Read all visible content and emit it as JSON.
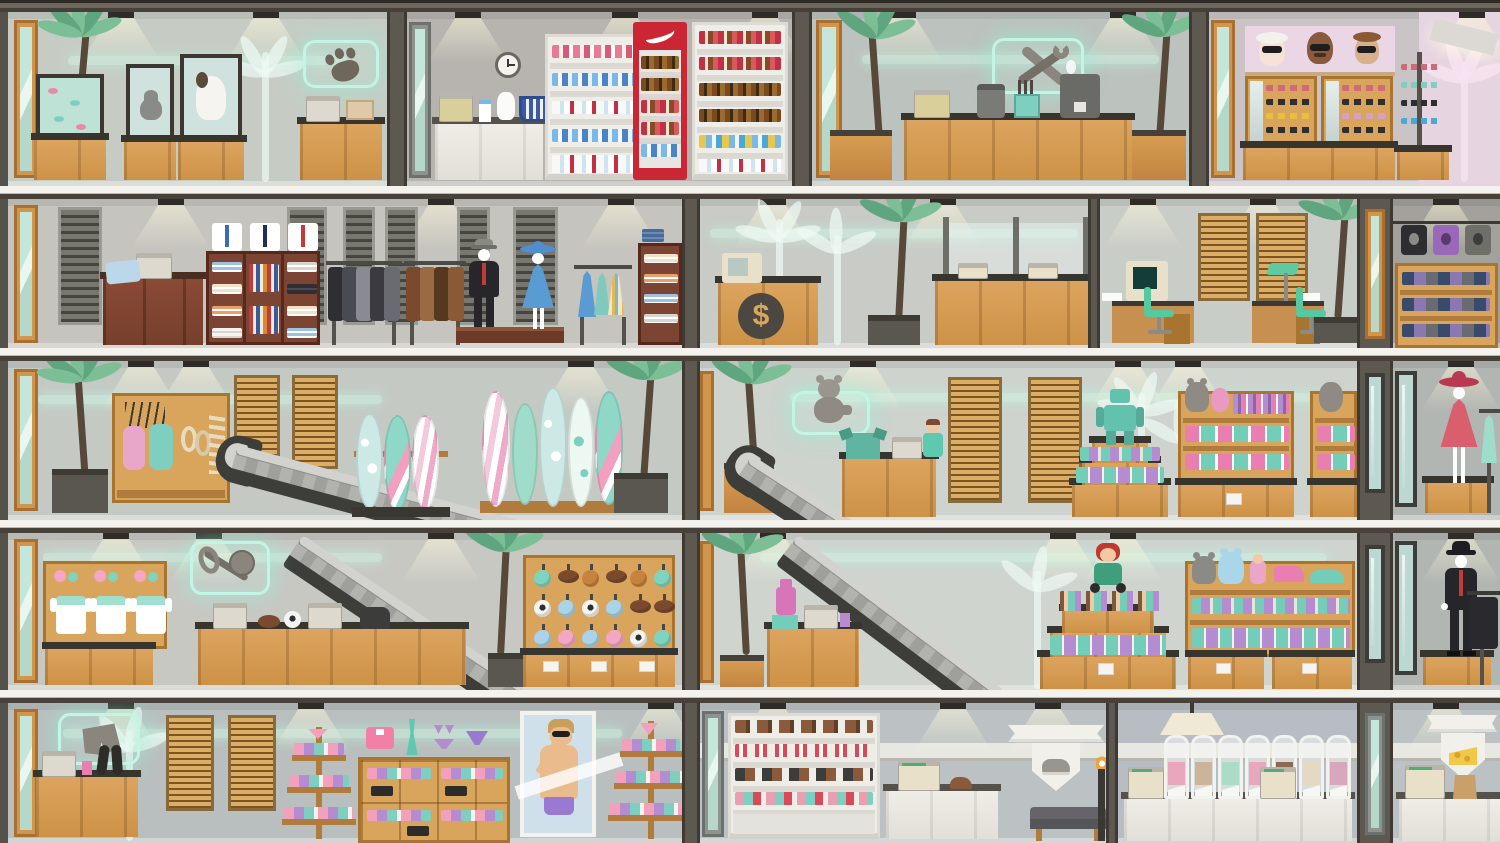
{
  "scene": {
    "type": "shopping-mall-cross-section",
    "floors": [
      {
        "id": "floor-1",
        "shops": [
          {
            "name": "pet-shop",
            "sign_icon": "paw-icon"
          },
          {
            "name": "convenience-store",
            "sign_icon": "none"
          },
          {
            "name": "repair-shop",
            "sign_icon": "wrench-icon"
          },
          {
            "name": "eyewear-shop",
            "sign_icon": "sunglasses-banner"
          }
        ]
      },
      {
        "id": "floor-2",
        "shops": [
          {
            "name": "menswear-store"
          },
          {
            "name": "bank-office",
            "emblem": "$"
          },
          {
            "name": "office"
          },
          {
            "name": "tshirt-shop"
          }
        ]
      },
      {
        "id": "floor-3",
        "shops": [
          {
            "name": "sporting-goods-surf-shop"
          },
          {
            "name": "toy-store",
            "sign_icon": "teddy-bear-icon"
          },
          {
            "name": "womens-boutique"
          }
        ]
      },
      {
        "id": "floor-4",
        "shops": [
          {
            "name": "sporting-goods-store",
            "sign_icon": "sports-gear-icon"
          },
          {
            "name": "toy-store-lower"
          },
          {
            "name": "menswear-boutique"
          }
        ]
      },
      {
        "id": "floor-5",
        "shops": [
          {
            "name": "swimwear-shop",
            "sign_icon": "swim-trunks-icon"
          },
          {
            "name": "shoe-store",
            "sign_icon": "shoe-crest"
          },
          {
            "name": "bulk-candy-store"
          },
          {
            "name": "deli-cheese-shop",
            "sign_icon": "cheese-crest"
          }
        ]
      }
    ]
  },
  "bank": {
    "emblem": "$"
  },
  "palette": {
    "frame_dark": "#47413a",
    "slab_white": "#f4f2ed",
    "wall_gray": "#c5c9c4",
    "wood_tan": "#d49a55",
    "dark_wood": "#7c4433",
    "neon_teal": "#c4f5e4",
    "glow_mint": "#cdf3e2",
    "palm_green": "#7cbf97",
    "escalator_gray": "#b2b2af",
    "cooler_red": "#cb2634",
    "accent_pink": "#f2a7c3",
    "accent_teal": "#74cdb8",
    "accent_purple": "#b48ccf"
  },
  "decor": {
    "ball_map": {
      "t": "#7fd4bf",
      "bb": "#c8823f",
      "bl": "#a9d3e8",
      "pk": "#f2a7c3",
      "fb": "#7b4a2e",
      "sc": "#f4f4f2"
    },
    "ball_names": {
      "t": "teal-ball",
      "bb": "basketball",
      "bl": "blue-ball",
      "pk": "pink-ball",
      "fb": "football",
      "sc": "soccer-ball"
    },
    "ball_rows": [
      [
        "t",
        "fb",
        "bb",
        "fb",
        "bb",
        "t"
      ],
      [
        "sc",
        "bl",
        "sc",
        "bl",
        "fb",
        "fb"
      ],
      [
        "bl",
        "pk",
        "bl",
        "pk",
        "sc",
        "t"
      ]
    ],
    "bin_fills": [
      "#e8a7bc",
      "#cbb49a",
      "#abdbc9",
      "#e8a7bc",
      "#8a6a52",
      "#e4d9c2",
      "#d8a7bc"
    ]
  }
}
